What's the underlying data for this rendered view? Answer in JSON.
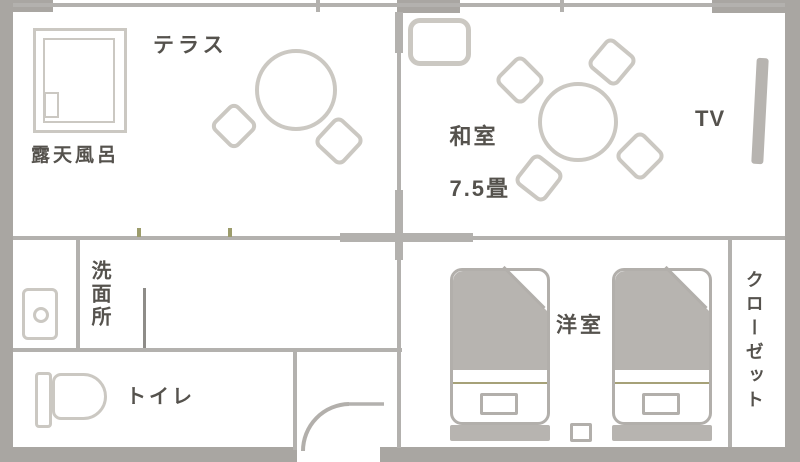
{
  "rooms": {
    "terrace": {
      "label": "テラス"
    },
    "open_air_bath": {
      "label": "露天風呂"
    },
    "japanese_room": {
      "label": "和室",
      "size": "7.5畳"
    },
    "tv": {
      "label": "TV"
    },
    "washroom": {
      "label": "洗面所"
    },
    "toilet": {
      "label": "トイレ"
    },
    "western_room": {
      "label": "洋室"
    },
    "closet": {
      "label": "クローゼット"
    }
  },
  "colors": {
    "outside_wall": "#a9a6a2",
    "inner_wall": "#b3b1ae",
    "furniture_outline": "#cbc8c2",
    "bed_outline": "#b2afab",
    "soft_fill": "#b7b4b0",
    "sheet_line": "#a6a178",
    "window_tick": "#9c9c6c",
    "fixture_line": "#8e8c88",
    "text": "#55524d",
    "room_fill": "#ffffff"
  }
}
